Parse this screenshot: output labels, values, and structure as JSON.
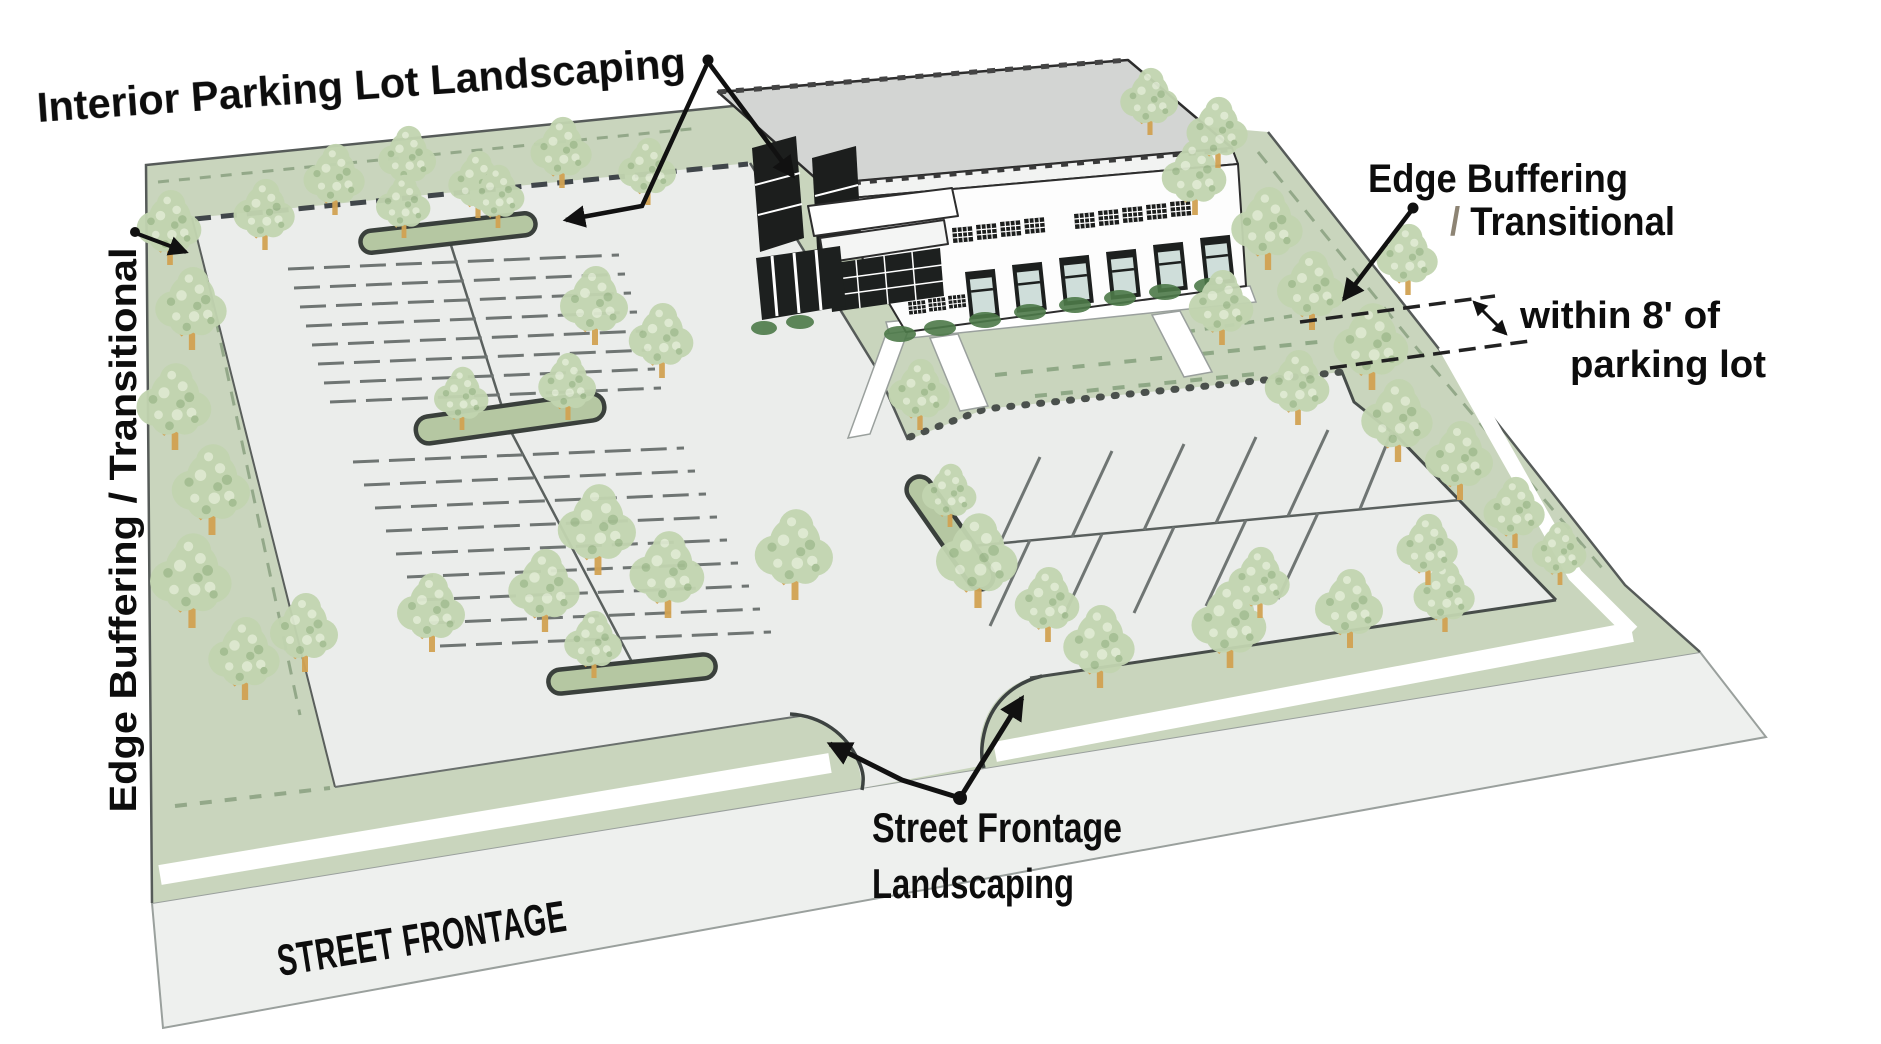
{
  "labels": {
    "interior": "Interior Parking Lot Landscaping",
    "edge_left": "Edge Buffering / Transitional",
    "edge_right_line1": "Edge Buffering",
    "edge_right_slash": "/ ",
    "edge_right_line2": "Transitional",
    "within_line1": "within 8' of",
    "within_line2": "parking lot",
    "frontage_line1": "Street Frontage",
    "frontage_line2": "Landscaping",
    "street": "STREET FRONTAGE"
  },
  "colors": {
    "site_green": "#c9d5bd",
    "pavement_gray": "#ebedeb",
    "street_gray": "#eef0ee",
    "island_green": "#b5c7a2",
    "tree_canopy": "#c2d5b0",
    "tree_trunk": "#d2a253",
    "curb_outline": "#3d4341",
    "stall_line": "#6f7573",
    "annotation_text": "#0d0d0d",
    "street_label_gray": "#b2b8b5",
    "slash_gray": "#8d8474"
  }
}
